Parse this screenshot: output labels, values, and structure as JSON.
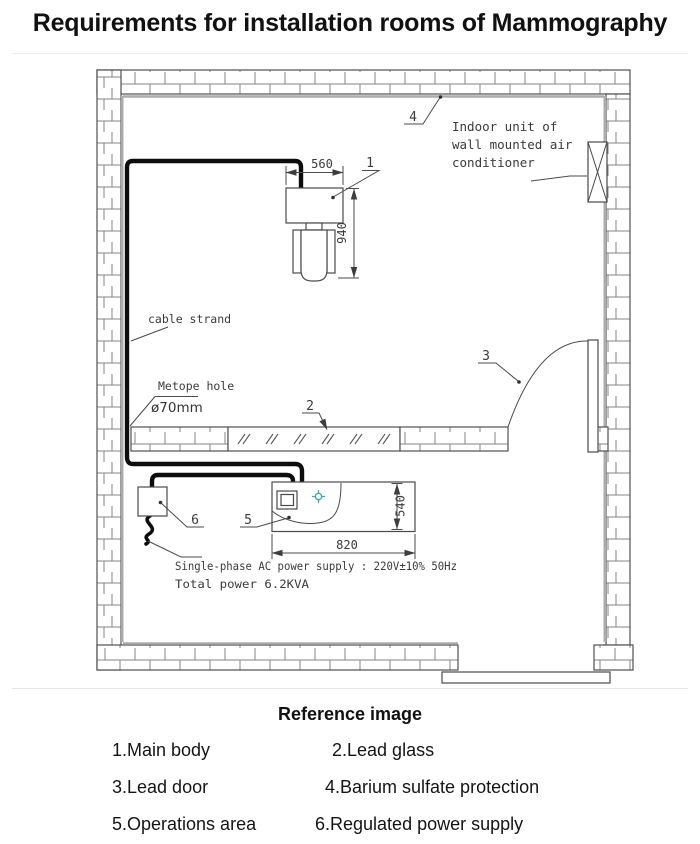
{
  "title": "Requirements for installation rooms of Mammography",
  "plan": {
    "ac_label": {
      "line1": "Indoor unit of",
      "line2": "wall mounted air",
      "line3": "conditioner"
    },
    "cable_strand_label": "cable strand",
    "metope_hole_label": "Metope hole",
    "metope_hole_diameter": "ø70mm",
    "power_supply_line1": "Single-phase AC power supply : 220V±10%  50Hz",
    "power_supply_line2": "Total power 6.2KVA",
    "dims": {
      "main_body_width": "560",
      "main_body_depth": "940",
      "desk_width": "820",
      "desk_depth": "540"
    },
    "callouts": {
      "main_body": "1",
      "lead_glass": "2",
      "lead_door": "3",
      "barium": "4",
      "operations": "5",
      "power": "6"
    },
    "colors": {
      "cable": "#0d0d0d",
      "protection": "#ababab",
      "crosshair": "#3fa9a9"
    }
  },
  "legend": {
    "heading": "Reference image",
    "items": [
      {
        "label": "1.Main body"
      },
      {
        "label": "2.Lead glass"
      },
      {
        "label": "3.Lead door"
      },
      {
        "label": "4.Barium sulfate protection"
      },
      {
        "label": "5.Operations area"
      },
      {
        "label": "6.Regulated power supply"
      }
    ]
  }
}
